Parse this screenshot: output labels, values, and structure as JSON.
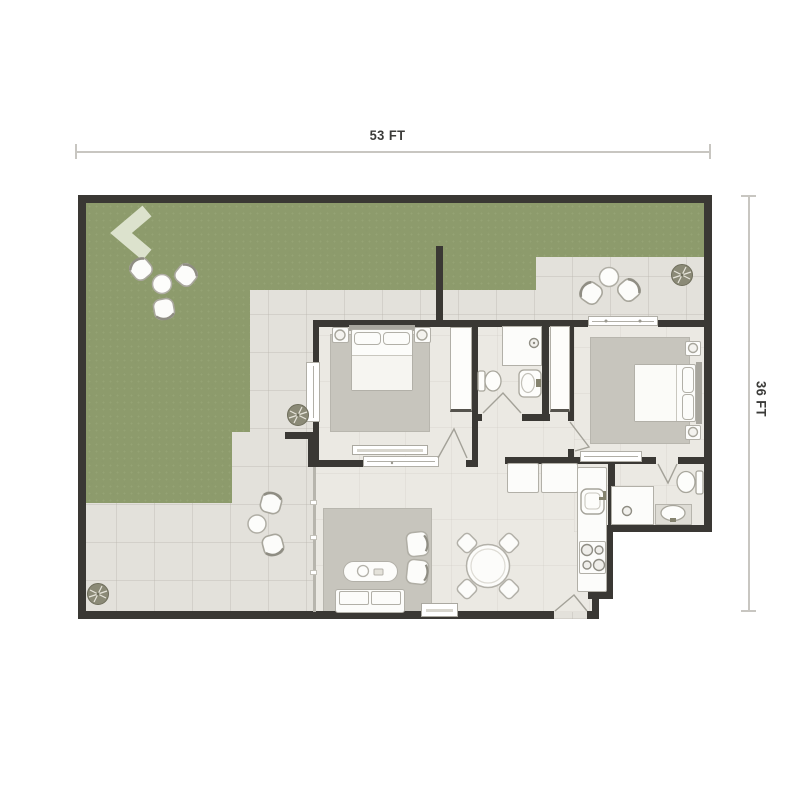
{
  "scene": {
    "type": "architectural-floor-plan",
    "view": "top-down"
  },
  "dimensions": {
    "width_label": "53 FT",
    "height_label": "36 FT"
  },
  "colors": {
    "grass": "#8d9b6c",
    "wall": "#3a3834",
    "patio": "#e3e1db",
    "floor": "#ebe9e3",
    "rug": "#c7c5bd",
    "furniture": "#fcfcfa",
    "outline": "#b2b0a8",
    "arrow": "#dce2cd",
    "dimline": "#c8c6c1",
    "text": "#3b3b39",
    "plant": "#8b8a77",
    "vanity": "#dedcd5"
  },
  "outdoor": {
    "areas": [
      "lawn",
      "rear-terrace",
      "side-patio"
    ],
    "items": [
      "entry-arrow",
      "lawn-chair-set-of-3-with-table",
      "terrace-chair-set-of-2-with-table",
      "patio-chair-set-of-2-with-table",
      "plant-terrace",
      "plant-mid-left",
      "plant-bottom-left"
    ]
  },
  "rooms": {
    "bedroom_1": {
      "furniture": [
        "double-bed",
        "nightstand-left",
        "nightstand-right",
        "lamp-left",
        "lamp-right",
        "area-rug",
        "wardrobe",
        "dresser",
        "window-left",
        "window-bottom",
        "door"
      ]
    },
    "bedroom_2": {
      "furniture": [
        "double-bed",
        "nightstand-top",
        "nightstand-bottom",
        "lamp-top",
        "lamp-bottom",
        "area-rug",
        "window-bottom",
        "sliding-glass-door-top",
        "door"
      ]
    },
    "bathroom_1": {
      "fixtures": [
        "shower",
        "toilet",
        "sink"
      ]
    },
    "bathroom_2": {
      "fixtures": [
        "shower",
        "toilet",
        "vanity-sink"
      ]
    },
    "kitchen": {
      "fixtures": [
        "counter-run",
        "kitchen-sink",
        "stove-4-burner",
        "cabinets"
      ]
    },
    "living_dining": {
      "furniture": [
        "sofa",
        "coffee-table",
        "armchair-1",
        "armchair-2",
        "tv-console",
        "area-rug",
        "round-dining-table",
        "dining-chairs-4",
        "entry-door",
        "glass-wall",
        "linen-closet-1",
        "linen-closet-2"
      ]
    }
  }
}
